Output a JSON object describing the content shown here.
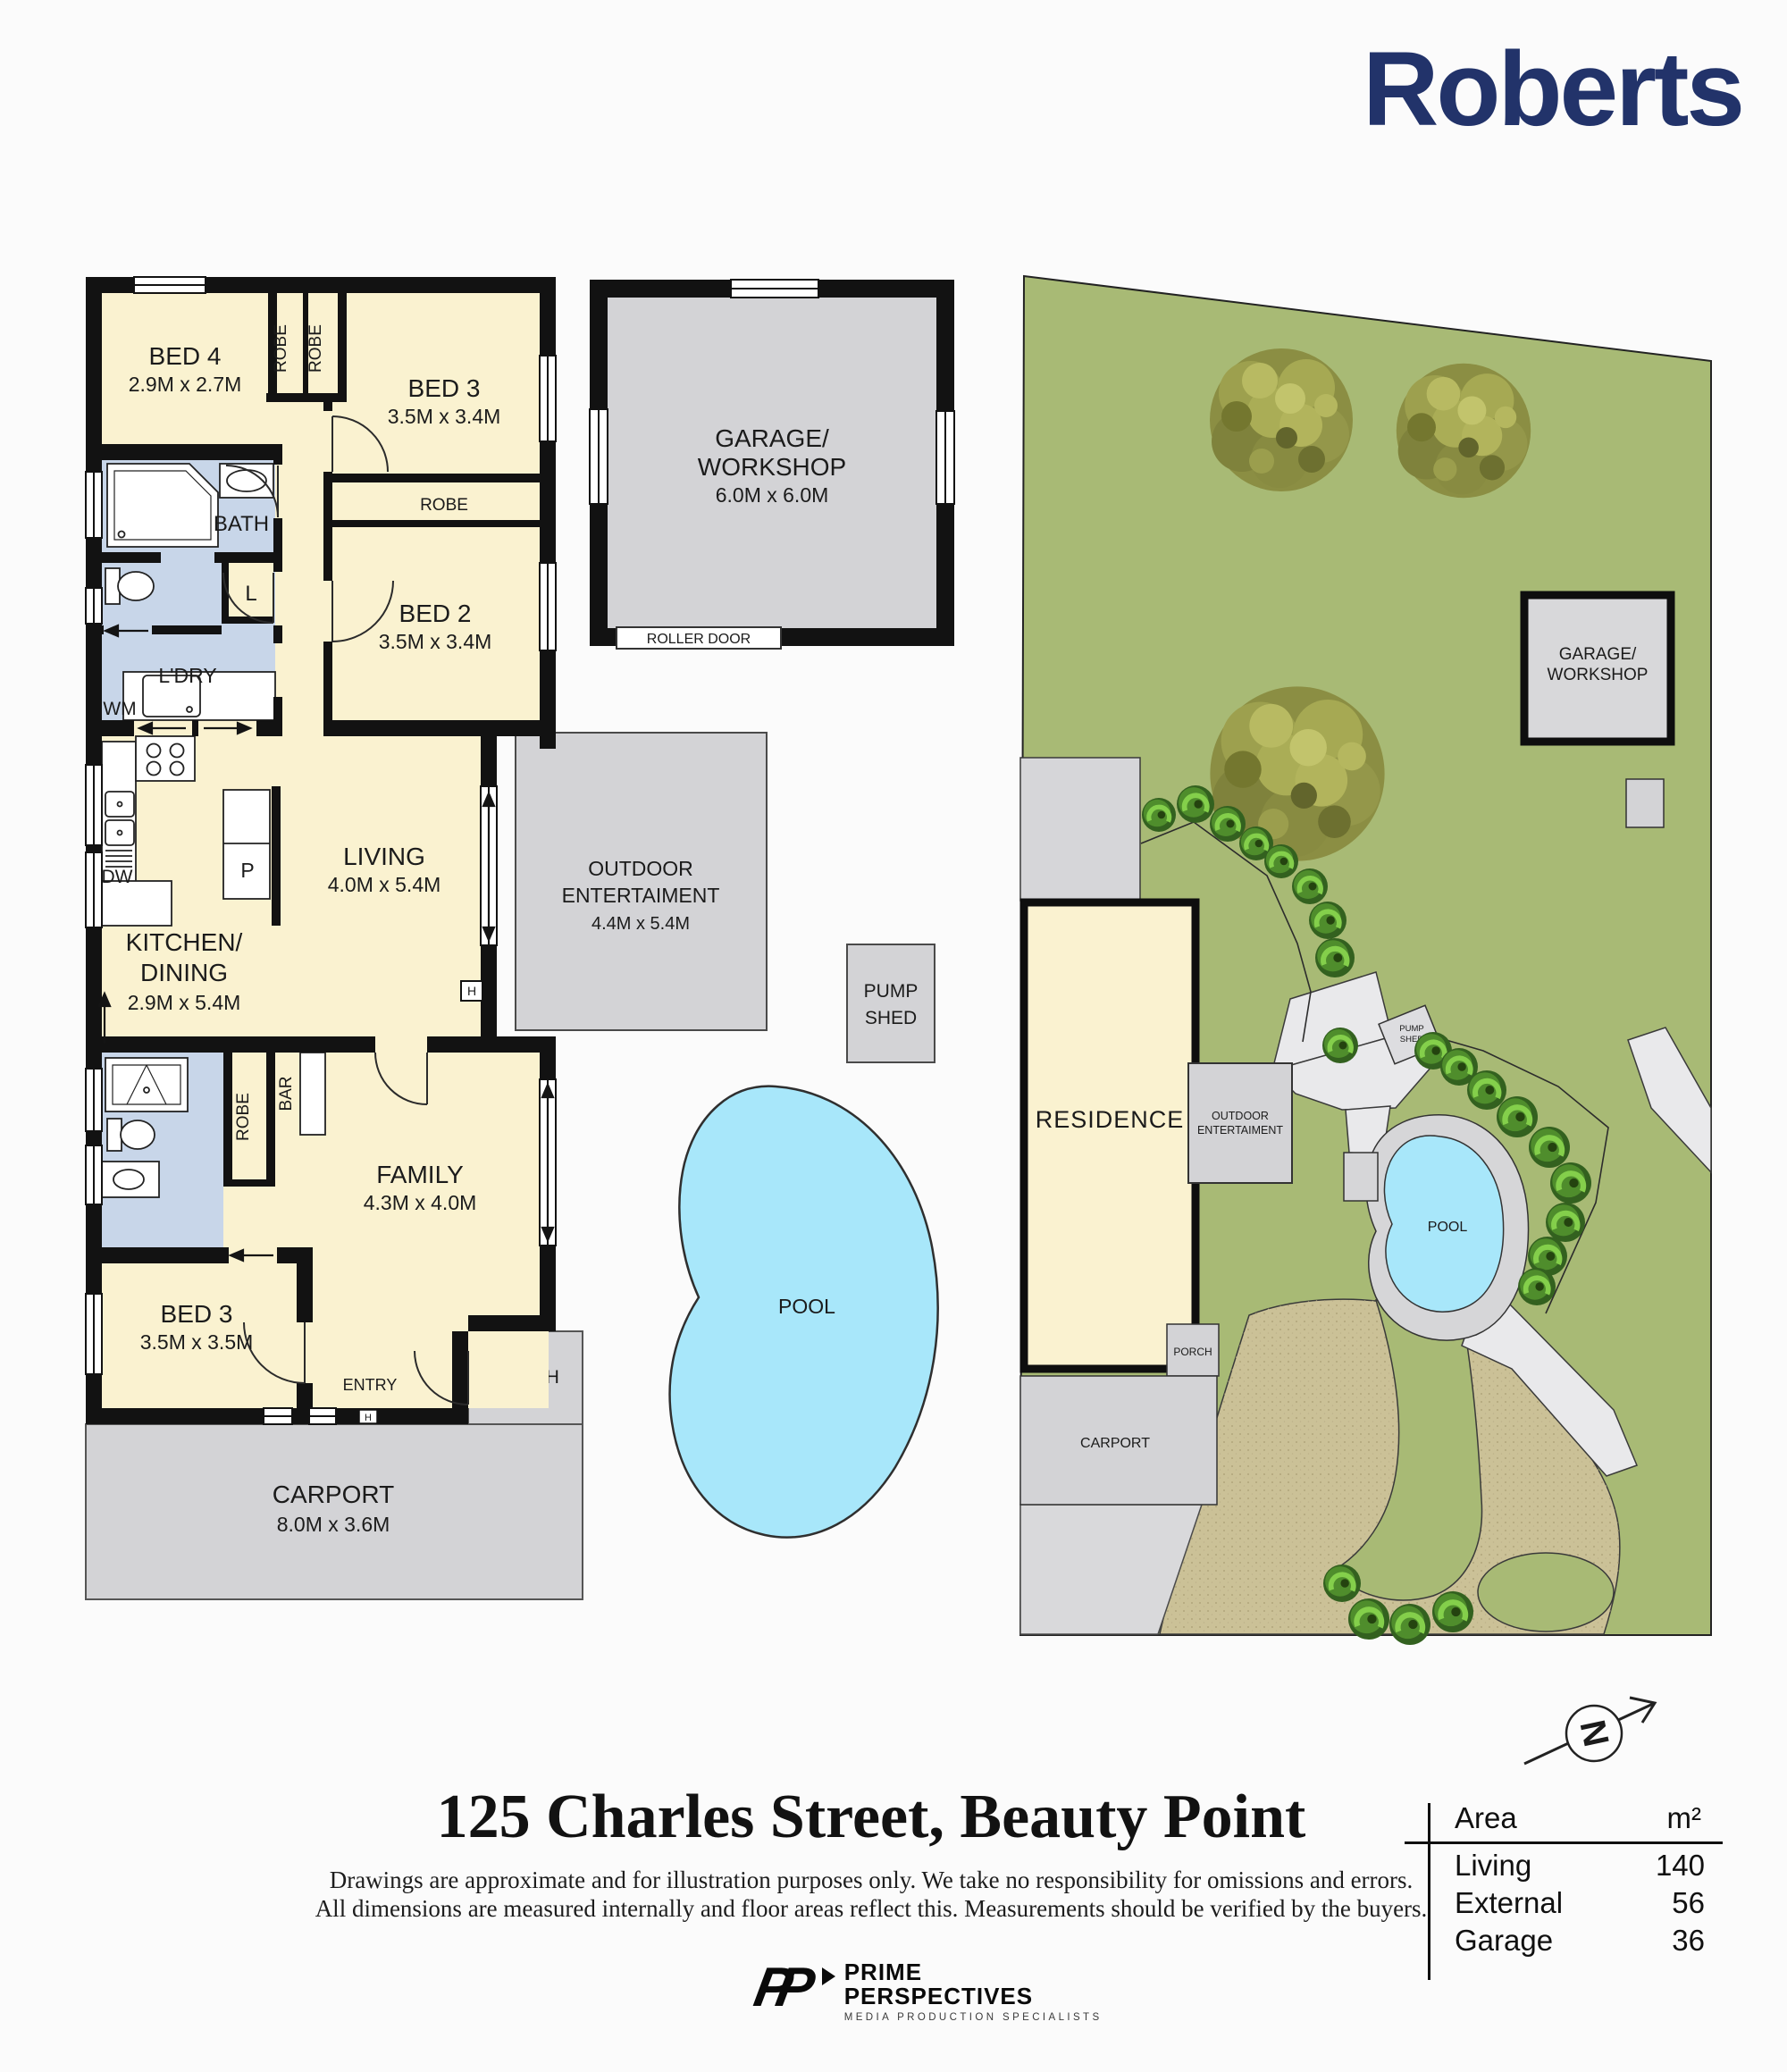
{
  "brand": {
    "name": "Roberts",
    "color": "#22336a"
  },
  "floorplan": {
    "bed4": {
      "name": "BED 4",
      "dims": "2.9M x 2.7M"
    },
    "bed3_top": {
      "name": "BED 3",
      "dims": "3.5M x 3.4M"
    },
    "bed2": {
      "name": "BED 2",
      "dims": "3.5M x 3.4M"
    },
    "living": {
      "name": "LIVING",
      "dims": "4.0M x 5.4M"
    },
    "kitchen": {
      "name_line1": "KITCHEN/",
      "name_line2": "DINING",
      "dims": "2.9M x 5.4M"
    },
    "family": {
      "name": "FAMILY",
      "dims": "4.3M x 4.0M"
    },
    "bed3_lower": {
      "name": "BED 3",
      "dims": "3.5M x 3.5M"
    },
    "carport": {
      "name": "CARPORT",
      "dims": "8.0M x 3.6M"
    },
    "garage": {
      "name_line1": "GARAGE/",
      "name_line2": "WORKSHOP",
      "dims": "6.0M x 6.0M"
    },
    "outdoor": {
      "name_line1": "OUTDOOR",
      "name_line2": "ENTERTAIMENT",
      "dims": "4.4M x 5.4M"
    },
    "pump_shed": {
      "line1": "PUMP",
      "line2": "SHED"
    },
    "labels": {
      "robe": "ROBE",
      "bath": "BATH",
      "laundry": "L'DRY",
      "wm": "WM",
      "dw": "DW",
      "pantry": "P",
      "linen": "L",
      "bar": "BAR",
      "entry": "ENTRY",
      "porch": "PORCH",
      "pool": "POOL",
      "roller_door": "ROLLER DOOR",
      "hot_water": "H"
    }
  },
  "siteplan": {
    "garage_line1": "GARAGE/",
    "garage_line2": "WORKSHOP",
    "residence": "RESIDENCE",
    "outdoor_line1": "OUTDOOR",
    "outdoor_line2": "ENTERTAIMENT",
    "pump_line1": "PUMP",
    "pump_line2": "SHED",
    "pool": "POOL",
    "porch": "PORCH",
    "carport": "CARPORT"
  },
  "compass": {
    "letter": "N"
  },
  "footer": {
    "title": "125 Charles Street, Beauty Point",
    "disclaimer_line1": "Drawings are approximate and for illustration purposes only. We take no responsibility for omissions and errors.",
    "disclaimer_line2": "All dimensions are measured internally and floor areas reflect this. Measurements should be verified by the buyers.",
    "area_table": {
      "col_label": "Area",
      "col_unit": "m²",
      "rows": [
        {
          "label": "Living",
          "value": "140"
        },
        {
          "label": "External",
          "value": "56"
        },
        {
          "label": "Garage",
          "value": "36"
        }
      ]
    },
    "credit": {
      "brand_line1": "PRIME",
      "brand_line2": "PERSPECTIVES",
      "tagline": "MEDIA PRODUCTION SPECIALISTS"
    }
  },
  "colors": {
    "wall": "#121212",
    "room_cream": "#faf2d0",
    "wet_blue": "#c8d6e9",
    "hard_gray": "#d3d3d6",
    "lawn": "#a8ba75",
    "sand": "#cbc197",
    "pool_blue": "#a8e7fa",
    "logo_navy": "#22336a"
  }
}
